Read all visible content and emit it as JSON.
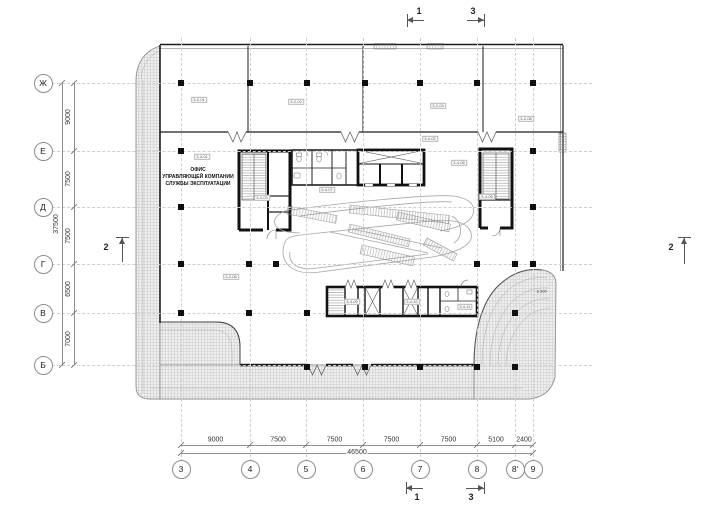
{
  "drawing": {
    "office_label": {
      "line1": "ОФИС",
      "line2": "УПРАВЛЯЮЩЕЙ КОМПАНИИ",
      "line3": "СЛУЖБЫ ЭКСПЛУАТАЦИИ"
    },
    "elevation_label": {
      "text": "-3.300",
      "x": 541,
      "y": 291
    },
    "rooms": [
      {
        "x": 199,
        "y": 100,
        "label": "3-2-01"
      },
      {
        "x": 296,
        "y": 102,
        "label": "3-2-02"
      },
      {
        "x": 438,
        "y": 106,
        "label": "3-2-03"
      },
      {
        "x": 526,
        "y": 119,
        "label": "3-2-08"
      },
      {
        "x": 202,
        "y": 157,
        "label": "3-4-01"
      },
      {
        "x": 430,
        "y": 139,
        "label": "3-4-02"
      },
      {
        "x": 327,
        "y": 190,
        "label": "3-4-07"
      },
      {
        "x": 459,
        "y": 163,
        "label": "3-4-08"
      },
      {
        "x": 262,
        "y": 198,
        "label": "3-4-03"
      },
      {
        "x": 487,
        "y": 197,
        "label": "3-4-06"
      },
      {
        "x": 231,
        "y": 277,
        "label": "3-2-05"
      },
      {
        "x": 352,
        "y": 302,
        "label": "3-4-09"
      },
      {
        "x": 412,
        "y": 302,
        "label": "3-4-10"
      },
      {
        "x": 465,
        "y": 307,
        "label": "3-4-11"
      }
    ],
    "grid": {
      "bubble_x": 43,
      "bubble_y": 469,
      "rows": [
        {
          "label": "Ж",
          "y": 83
        },
        {
          "label": "Е",
          "y": 151
        },
        {
          "label": "Д",
          "y": 207
        },
        {
          "label": "Г",
          "y": 264
        },
        {
          "label": "В",
          "y": 313
        },
        {
          "label": "Б",
          "y": 365
        }
      ],
      "cols": [
        {
          "label": "3",
          "x": 181
        },
        {
          "label": "4",
          "x": 250
        },
        {
          "label": "5",
          "x": 306
        },
        {
          "label": "6",
          "x": 363
        },
        {
          "label": "7",
          "x": 420
        },
        {
          "label": "8",
          "x": 477
        },
        {
          "label": "8'",
          "x": 515
        },
        {
          "label": "9",
          "x": 533
        }
      ]
    },
    "dimensions": {
      "left": {
        "line_x": 74,
        "total_line_x": 62,
        "segments": [
          {
            "label": "9000",
            "from": 83,
            "to": 151
          },
          {
            "label": "7500",
            "from": 151,
            "to": 207
          },
          {
            "label": "7500",
            "from": 207,
            "to": 264
          },
          {
            "label": "6500",
            "from": 264,
            "to": 313
          },
          {
            "label": "7000",
            "from": 313,
            "to": 365
          }
        ],
        "total": {
          "label": "37500",
          "from": 83,
          "to": 365
        }
      },
      "bottom": {
        "line_y": 445,
        "total_line_y": 453,
        "segments": [
          {
            "label": "9000",
            "from": 181,
            "to": 250
          },
          {
            "label": "7500",
            "from": 250,
            "to": 306
          },
          {
            "label": "7500",
            "from": 306,
            "to": 363
          },
          {
            "label": "7500",
            "from": 363,
            "to": 420
          },
          {
            "label": "7500",
            "from": 420,
            "to": 477
          },
          {
            "label": "5100",
            "from": 477,
            "to": 515
          },
          {
            "label": "2400",
            "from": 515,
            "to": 533
          }
        ],
        "total": {
          "label": "46500",
          "from": 181,
          "to": 533
        }
      }
    },
    "columns": [
      [
        181,
        83
      ],
      [
        250,
        83
      ],
      [
        307,
        83
      ],
      [
        365,
        83
      ],
      [
        420,
        83
      ],
      [
        477,
        83
      ],
      [
        533,
        83
      ],
      [
        181,
        151
      ],
      [
        533,
        151
      ],
      [
        181,
        207
      ],
      [
        533,
        207
      ],
      [
        181,
        264
      ],
      [
        249,
        264
      ],
      [
        276,
        264
      ],
      [
        477,
        264
      ],
      [
        515,
        264
      ],
      [
        533,
        264
      ],
      [
        181,
        313
      ],
      [
        249,
        313
      ],
      [
        307,
        313
      ],
      [
        515,
        313
      ],
      [
        307,
        367
      ],
      [
        365,
        367
      ],
      [
        420,
        367
      ],
      [
        477,
        367
      ],
      [
        515,
        367
      ]
    ],
    "section_markers": [
      {
        "label": "1",
        "label_x": 419,
        "label_y": 11,
        "line": [
          407,
          20,
          424,
          20
        ],
        "tick": [
          407,
          14,
          407,
          27
        ],
        "arrow": "left",
        "arrow_x": 407,
        "arrow_y": 20
      },
      {
        "label": "3",
        "label_x": 473,
        "label_y": 11,
        "line": [
          467,
          20,
          484,
          20
        ],
        "tick": [
          484,
          14,
          484,
          27
        ],
        "arrow": "right",
        "arrow_x": 484,
        "arrow_y": 20
      },
      {
        "label": "1",
        "label_x": 417,
        "label_y": 497,
        "line": [
          406,
          488,
          423,
          488
        ],
        "tick": [
          406,
          482,
          406,
          494
        ],
        "arrow": "left",
        "arrow_x": 406,
        "arrow_y": 488
      },
      {
        "label": "3",
        "label_x": 471,
        "label_y": 497,
        "line": [
          466,
          488,
          484,
          488
        ],
        "tick": [
          484,
          482,
          484,
          494
        ],
        "arrow": "right",
        "arrow_x": 484,
        "arrow_y": 488
      },
      {
        "label": "2",
        "label_x": 106,
        "label_y": 247,
        "line": [
          122,
          238,
          122,
          262
        ],
        "tick": [
          116,
          237,
          129,
          237
        ],
        "arrow": "up",
        "arrow_x": 122,
        "arrow_y": 238
      },
      {
        "label": "2",
        "label_x": 671,
        "label_y": 247,
        "line": [
          684,
          238,
          684,
          264
        ],
        "tick": [
          678,
          237,
          691,
          237
        ],
        "arrow": "up",
        "arrow_x": 684,
        "arrow_y": 238
      }
    ]
  }
}
